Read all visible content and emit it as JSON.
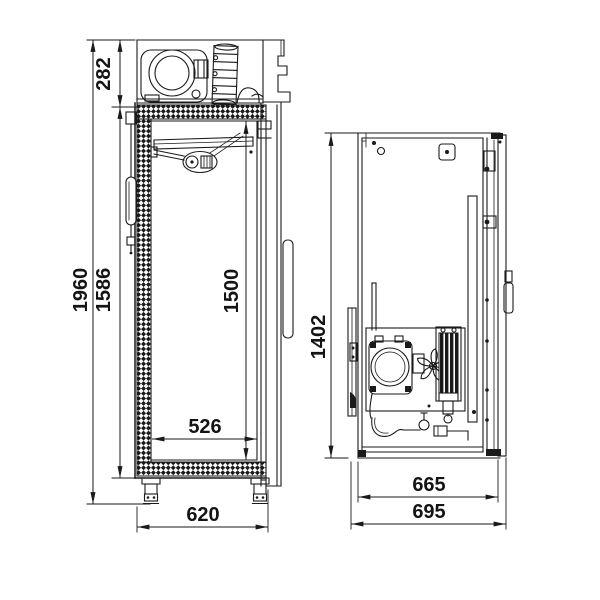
{
  "drawing": {
    "front_view": {
      "overall_height": "1960",
      "machine_compartment_height": "282",
      "insulated_body_height": "1586",
      "interior_height": "1500",
      "interior_width": "526",
      "overall_width": "620"
    },
    "side_view": {
      "body_height": "1402",
      "body_depth": "665",
      "overall_depth": "695"
    },
    "colors": {
      "line": "#1a1a1a",
      "background": "#ffffff"
    }
  }
}
